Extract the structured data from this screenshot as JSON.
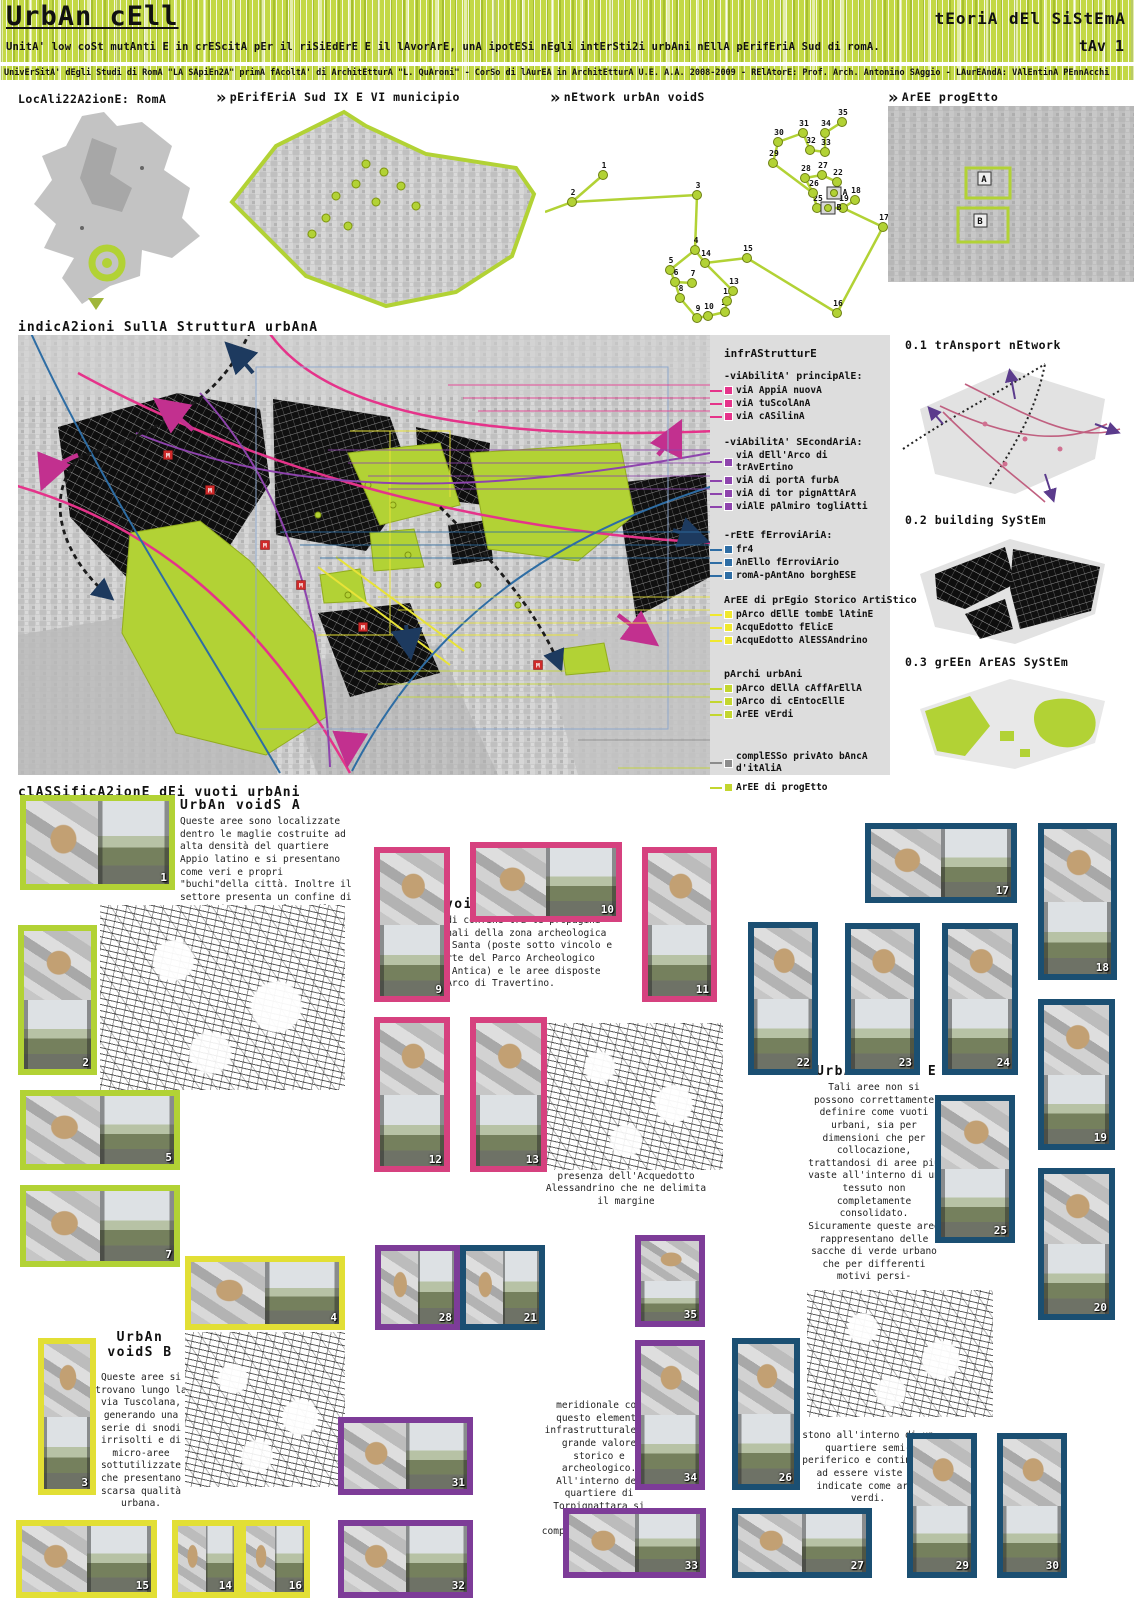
{
  "header": {
    "title": "UrbAn cEll",
    "right_title": "tEoriA dEl SiStEmA",
    "subtitle": "UnitA' low coSt mutAnti E in crEScitA pEr il riSiEdErE E il lAvorArE, unA ipotESi nEgli intErSti2i urbAni nEllA pErifEriA Sud di romA.",
    "tav": "tAv 1",
    "credits": "UnivErSitA' dEgli Studi di RomA \"LA SApiEn2A\" primA fAcoltA' di ArchitEtturA \"L. QuAroni\" - CorSo di lAurEA in ArchitEtturA U.E. A.A. 2008-2009 - RElAtorE: Prof. Arch. Antonino SAggio - LAurEAndA: VAlEntinA PEnnAcchi"
  },
  "top_sections": {
    "localization": "LocAli22A2ionE: RomA",
    "periferia": "pErifEriA Sud IX E VI municipio",
    "network": "nEtwork urbAn voidS",
    "aree": "ArEE progEtto",
    "area_labels": [
      "A",
      "B"
    ]
  },
  "network": {
    "nodes": [
      {
        "id": "1",
        "x": 58,
        "y": 75
      },
      {
        "id": "2",
        "x": 27,
        "y": 102
      },
      {
        "id": "3",
        "x": 152,
        "y": 95
      },
      {
        "id": "4",
        "x": 150,
        "y": 150
      },
      {
        "id": "5",
        "x": 125,
        "y": 170
      },
      {
        "id": "6",
        "x": 130,
        "y": 182
      },
      {
        "id": "7",
        "x": 147,
        "y": 183
      },
      {
        "id": "8",
        "x": 135,
        "y": 198
      },
      {
        "id": "9",
        "x": 152,
        "y": 218
      },
      {
        "id": "10",
        "x": 163,
        "y": 216
      },
      {
        "id": "11",
        "x": 180,
        "y": 212
      },
      {
        "id": "12",
        "x": 182,
        "y": 201
      },
      {
        "id": "13",
        "x": 188,
        "y": 191
      },
      {
        "id": "14",
        "x": 160,
        "y": 163
      },
      {
        "id": "15",
        "x": 202,
        "y": 158
      },
      {
        "id": "16",
        "x": 292,
        "y": 213
      },
      {
        "id": "17",
        "x": 338,
        "y": 127
      },
      {
        "id": "18",
        "x": 310,
        "y": 100
      },
      {
        "id": "19",
        "x": 298,
        "y": 108
      },
      {
        "id": "22",
        "x": 292,
        "y": 82
      },
      {
        "id": "25",
        "x": 272,
        "y": 108
      },
      {
        "id": "26",
        "x": 268,
        "y": 93
      },
      {
        "id": "27",
        "x": 277,
        "y": 75
      },
      {
        "id": "28",
        "x": 260,
        "y": 78
      },
      {
        "id": "29",
        "x": 228,
        "y": 63
      },
      {
        "id": "30",
        "x": 233,
        "y": 42
      },
      {
        "id": "31",
        "x": 258,
        "y": 33
      },
      {
        "id": "32",
        "x": 265,
        "y": 50
      },
      {
        "id": "33",
        "x": 280,
        "y": 52
      },
      {
        "id": "34",
        "x": 280,
        "y": 33
      },
      {
        "id": "35",
        "x": 297,
        "y": 22
      },
      {
        "id": "A",
        "x": 289,
        "y": 93,
        "sq": true
      },
      {
        "id": "B",
        "x": 283,
        "y": 108,
        "sq": true
      }
    ],
    "edges": [
      [
        "1",
        "2"
      ],
      [
        "2",
        "3"
      ],
      [
        "3",
        "4"
      ],
      [
        "4",
        "5"
      ],
      [
        "5",
        "6"
      ],
      [
        "6",
        "7"
      ],
      [
        "6",
        "8"
      ],
      [
        "8",
        "9"
      ],
      [
        "9",
        "10"
      ],
      [
        "10",
        "11"
      ],
      [
        "11",
        "12"
      ],
      [
        "12",
        "13"
      ],
      [
        "13",
        "14"
      ],
      [
        "14",
        "4"
      ],
      [
        "14",
        "15"
      ],
      [
        "15",
        "16"
      ],
      [
        "16",
        "17"
      ],
      [
        "17",
        "19"
      ],
      [
        "19",
        "18"
      ],
      [
        "19",
        "25"
      ],
      [
        "25",
        "26"
      ],
      [
        "26",
        "28"
      ],
      [
        "28",
        "27"
      ],
      [
        "27",
        "22"
      ],
      [
        "26",
        "29"
      ],
      [
        "29",
        "30"
      ],
      [
        "30",
        "31"
      ],
      [
        "31",
        "32"
      ],
      [
        "32",
        "33"
      ],
      [
        "33",
        "34"
      ],
      [
        "34",
        "35"
      ]
    ]
  },
  "structure": {
    "title": "indicA2ioni SullA StrutturA urbAnA",
    "legend": {
      "heading": "infrAStrutturE",
      "groups": [
        {
          "title": "-viAbilitA' principAlE:",
          "color": "#e5338a",
          "items": [
            "viA AppiA nuovA",
            "viA tuScolAnA",
            "viA cASilinA"
          ]
        },
        {
          "title": "-viAbilitA' SEcondAriA:",
          "color": "#8e44ad",
          "items": [
            "viA dEll'Arco di trAvErtino",
            "viA di portA furbA",
            "viA di tor pignAttArA",
            "viAlE pAlmiro togliAtti"
          ]
        },
        {
          "title": "-rEtE fErroviAriA:",
          "color": "#2e6da4",
          "items": [
            "fr4",
            "AnEllo fErroviArio",
            "romA-pAntAno borghESE"
          ]
        },
        {
          "title": "ArEE di prEgio Storico ArtiStico",
          "color": "#f0e82e",
          "items": [
            "pArco dEllE tombE lAtinE",
            "AcquEdotto fElicE",
            "AcquEdotto AlESSAndrino"
          ]
        },
        {
          "title": "pArchi urbAni",
          "color": "#c3d62f",
          "items": [
            "pArco dEllA cAffArEllA",
            "pArco di cEntocEllE",
            "ArEE vErdi"
          ]
        },
        {
          "title": "",
          "color": "#8c8c8c",
          "items": [
            "complESSo privAto bAncA d'itAliA"
          ]
        },
        {
          "title": "",
          "color": "#c3d62f",
          "items": [
            "ArEE di progEtto"
          ]
        }
      ]
    },
    "side_diagrams": [
      "0.1 trAnsport nEtwork",
      "0.2 building SyStEm",
      "0.3 grEEn ArEAS SyStEm"
    ]
  },
  "classification": {
    "title": "clASSificA2ionE dEi vuoti urbAni",
    "voids": [
      {
        "id": "A",
        "title": "UrbAn voidS A",
        "text": "Queste aree sono localizzate dentro le maglie costruite ad alta densità del quartiere Appio latino e si presentano come veri e propri \"buchi\"della città. Inoltre il settore presenta un confine di grande importanza lungo il Parco dell'Appia."
      },
      {
        "id": "B",
        "title": "UrbAn voidS B",
        "text": "Queste aree si trovano lungo la via Tuscolana, generando una serie di snodi irrisolti e di micro-aree sottutilizzate che presentano scarsa qualità urbana."
      },
      {
        "id": "C",
        "title": "UrbAn voidS C",
        "text": "Sono aree di confine tra le propagini settentrionali della zona archeologica dell'Acqua Santa (poste sotto vincolo e facenti parte del Parco Archeologico dell'Appia Antica) e le aree disposte lungo Via Arco di Travertino."
      },
      {
        "id": "D",
        "title": "UrbAn voidS D",
        "text": "Zona caratterizzata dalla presenza dell'Acquedotto Alessandrino che ne delimita il margine",
        "text2": "meridionale con questo elemento infrastrutturale di grande valore storico e archeologico. All'interno del quartiere di Torpignattara si individua il complesso Inacasa su via Rovetti."
      },
      {
        "id": "E",
        "title": "UrbAn voidS E",
        "text": "Tali aree non si possono correttamente definire come vuoti urbani, sia per dimensioni che per collocazione, trattandosi di aree più vaste all'interno di un tessuto non completamente consolidato. Sicuramente queste aree rappresentano delle sacche di verde urbano che per differenti motivi persi-",
        "text2": "stono all'interno di un quartiere semi-periferico e continuano ad essere viste ed indicate come aree verdi."
      }
    ],
    "tiles": [
      {
        "n": "1",
        "g": "A",
        "x": 20,
        "y": 795,
        "w": 155,
        "h": 95,
        "o": "h"
      },
      {
        "n": "2",
        "g": "A",
        "x": 18,
        "y": 925,
        "w": 79,
        "h": 150,
        "o": "v"
      },
      {
        "n": "5",
        "g": "A",
        "x": 20,
        "y": 1090,
        "w": 160,
        "h": 80,
        "o": "h"
      },
      {
        "n": "7",
        "g": "A",
        "x": 20,
        "y": 1185,
        "w": 160,
        "h": 82,
        "o": "h"
      },
      {
        "n": "3",
        "g": "B",
        "x": 38,
        "y": 1338,
        "w": 58,
        "h": 157,
        "o": "v"
      },
      {
        "n": "4",
        "g": "B",
        "x": 185,
        "y": 1256,
        "w": 160,
        "h": 74,
        "o": "h"
      },
      {
        "n": "15",
        "g": "B",
        "x": 16,
        "y": 1520,
        "w": 141,
        "h": 78,
        "o": "h"
      },
      {
        "n": "14",
        "g": "B",
        "x": 172,
        "y": 1520,
        "w": 68,
        "h": 78,
        "o": "h"
      },
      {
        "n": "16",
        "g": "B",
        "x": 240,
        "y": 1520,
        "w": 70,
        "h": 78,
        "o": "h"
      },
      {
        "n": "9",
        "g": "C",
        "x": 374,
        "y": 847,
        "w": 76,
        "h": 155,
        "o": "v"
      },
      {
        "n": "10",
        "g": "C",
        "x": 470,
        "y": 842,
        "w": 152,
        "h": 80,
        "o": "h"
      },
      {
        "n": "11",
        "g": "C",
        "x": 642,
        "y": 847,
        "w": 75,
        "h": 155,
        "o": "v"
      },
      {
        "n": "12",
        "g": "C",
        "x": 374,
        "y": 1017,
        "w": 76,
        "h": 155,
        "o": "v"
      },
      {
        "n": "13",
        "g": "C",
        "x": 470,
        "y": 1017,
        "w": 77,
        "h": 155,
        "o": "v"
      },
      {
        "n": "28",
        "g": "D",
        "x": 375,
        "y": 1245,
        "w": 85,
        "h": 85,
        "o": "h"
      },
      {
        "n": "35",
        "g": "D",
        "x": 635,
        "y": 1235,
        "w": 70,
        "h": 92,
        "o": "v"
      },
      {
        "n": "34",
        "g": "D",
        "x": 635,
        "y": 1340,
        "w": 70,
        "h": 150,
        "o": "v"
      },
      {
        "n": "31",
        "g": "D",
        "x": 338,
        "y": 1417,
        "w": 135,
        "h": 78,
        "o": "h"
      },
      {
        "n": "32",
        "g": "D",
        "x": 338,
        "y": 1520,
        "w": 135,
        "h": 78,
        "o": "h"
      },
      {
        "n": "33",
        "g": "D",
        "x": 563,
        "y": 1508,
        "w": 143,
        "h": 70,
        "o": "h"
      },
      {
        "n": "21",
        "g": "E",
        "x": 460,
        "y": 1245,
        "w": 85,
        "h": 85,
        "o": "h"
      },
      {
        "n": "17",
        "g": "E",
        "x": 865,
        "y": 823,
        "w": 152,
        "h": 80,
        "o": "h"
      },
      {
        "n": "18",
        "g": "E",
        "x": 1038,
        "y": 823,
        "w": 79,
        "h": 157,
        "o": "v"
      },
      {
        "n": "22",
        "g": "E",
        "x": 748,
        "y": 922,
        "w": 70,
        "h": 153,
        "o": "v"
      },
      {
        "n": "23",
        "g": "E",
        "x": 845,
        "y": 923,
        "w": 75,
        "h": 152,
        "o": "v"
      },
      {
        "n": "24",
        "g": "E",
        "x": 942,
        "y": 923,
        "w": 76,
        "h": 152,
        "o": "v"
      },
      {
        "n": "19",
        "g": "E",
        "x": 1038,
        "y": 999,
        "w": 77,
        "h": 151,
        "o": "v"
      },
      {
        "n": "25",
        "g": "E",
        "x": 935,
        "y": 1095,
        "w": 80,
        "h": 148,
        "o": "v"
      },
      {
        "n": "20",
        "g": "E",
        "x": 1038,
        "y": 1168,
        "w": 77,
        "h": 152,
        "o": "v"
      },
      {
        "n": "26",
        "g": "E",
        "x": 732,
        "y": 1338,
        "w": 68,
        "h": 152,
        "o": "v"
      },
      {
        "n": "27",
        "g": "E",
        "x": 732,
        "y": 1508,
        "w": 140,
        "h": 70,
        "o": "h"
      },
      {
        "n": "29",
        "g": "E",
        "x": 907,
        "y": 1433,
        "w": 70,
        "h": 145,
        "o": "v"
      },
      {
        "n": "30",
        "g": "E",
        "x": 997,
        "y": 1433,
        "w": 70,
        "h": 145,
        "o": "v"
      }
    ]
  },
  "colors": {
    "lime": "#b2d235",
    "yellow": "#e2df35",
    "pink": "#d6417f",
    "purple": "#7d3c98",
    "navy": "#1b4f72",
    "magenta": "#e5338a",
    "violet": "#8e44ad",
    "blue": "#2e6da4",
    "legend_yellow": "#f0e82e",
    "gray": "#8c8c8c"
  }
}
